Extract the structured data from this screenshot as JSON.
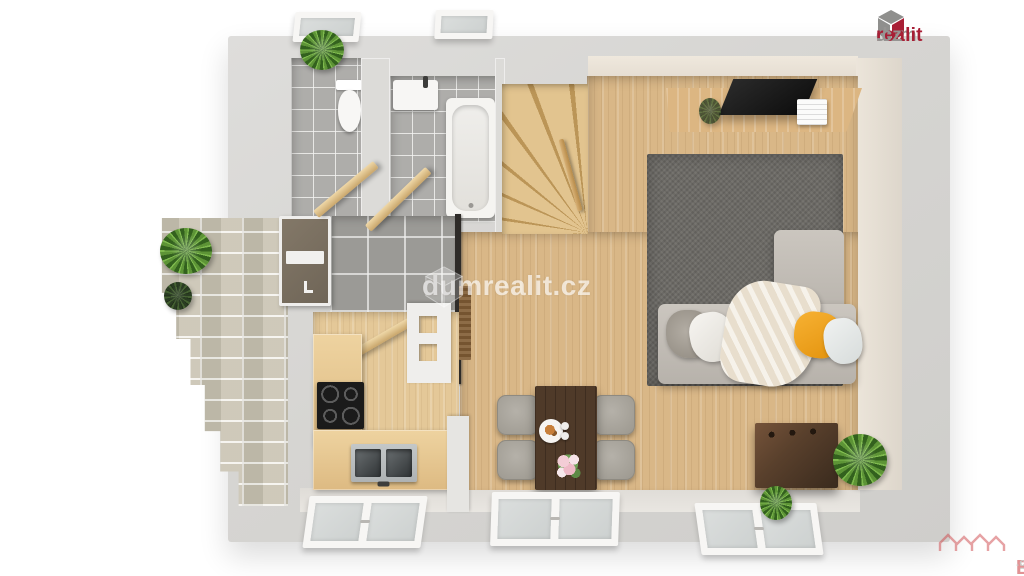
{
  "branding": {
    "corner_logo": {
      "dum": "dum",
      "realit": "realit",
      "cz": ".cz"
    },
    "center_watermark": {
      "text": "dumrealit.cz"
    },
    "bottom_watermark": {
      "real": "Real",
      "bonus": "Bonus",
      "cz": ".cz"
    }
  },
  "palette": {
    "background": "#ffffff",
    "wall_gray": "#d6d5d2",
    "inner_wall_beige": "#e9e2d7",
    "wood_floor": "#d9b787",
    "kitchen_floor": "#e4c898",
    "bath_tile": "#aeadaa",
    "hall_tile": "#9b9a96",
    "stone_patio": "#c8c2b1",
    "rug_gray": "#6d6b66",
    "sofa_gray": "#c1bcb5",
    "pillow_orange": "#f2a51f",
    "dining_table_wood": "#4f3a29",
    "chest_wood": "#59402c",
    "front_door": "#7b7165",
    "tv_black": "#141414",
    "plant_green": "#5d9436",
    "logo_red": "#a81e35",
    "realbonus_red": "#cf4a4e"
  },
  "scene": {
    "view": "top-down 3D floor plan render",
    "rooms": [
      "wc",
      "bathroom",
      "hallway",
      "kitchen",
      "living-room",
      "dining-area",
      "staircase",
      "stone-patio"
    ],
    "furniture": [
      "toilet",
      "washbasin",
      "bathtub",
      "winder-staircase",
      "tv-sideboard",
      "tv",
      "area-rug",
      "corner-sofa",
      "throw-blanket",
      "pillows",
      "dining-table",
      "dining-chairs",
      "kitchen-counter",
      "induction-cooktop",
      "double-sink",
      "front-door",
      "interior-doors",
      "storage-chest",
      "potted-plants",
      "windows"
    ]
  }
}
